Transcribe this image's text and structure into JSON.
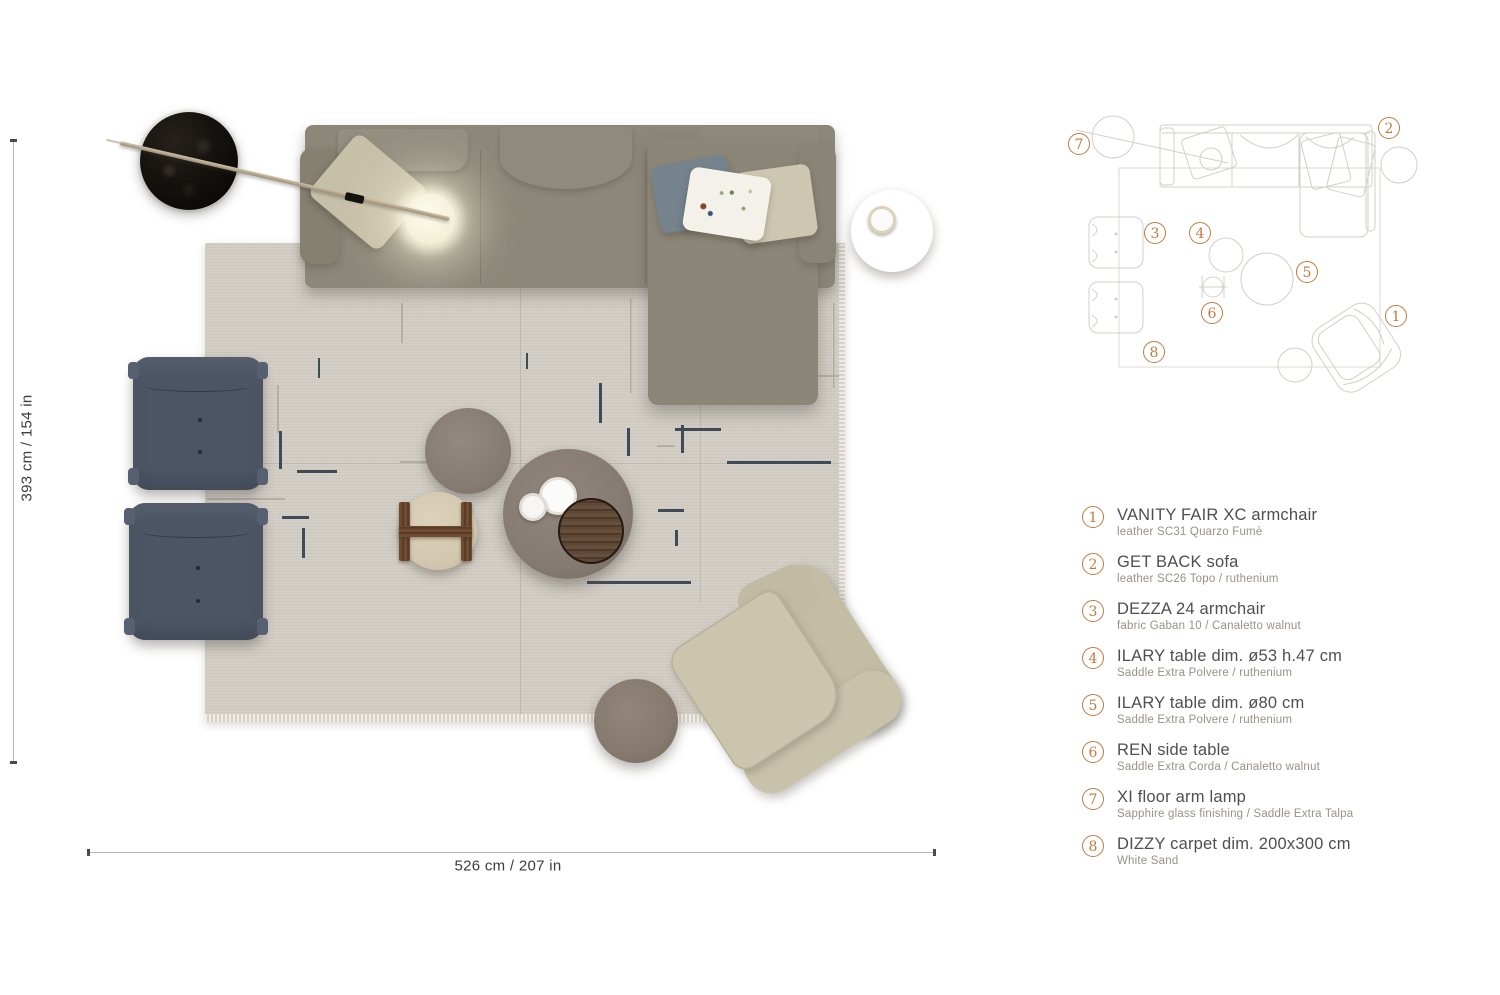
{
  "dimensions": {
    "vertical_label": "393 cm / 154 in",
    "horizontal_label": "526 cm / 207 in"
  },
  "legend": {
    "items": [
      {
        "num": "1",
        "title": "VANITY FAIR XC armchair",
        "spec": "leather SC31 Quarzo Fumè"
      },
      {
        "num": "2",
        "title": "GET BACK sofa",
        "spec": "leather SC26 Topo / ruthenium"
      },
      {
        "num": "3",
        "title": "DEZZA 24 armchair",
        "spec": "fabric Gaban 10 / Canaletto walnut"
      },
      {
        "num": "4",
        "title": "ILARY table dim. ø53 h.47 cm",
        "spec": "Saddle Extra Polvere / ruthenium"
      },
      {
        "num": "5",
        "title": "ILARY table dim. ø80 cm",
        "spec": "Saddle Extra Polvere / ruthenium"
      },
      {
        "num": "6",
        "title": "REN side table",
        "spec": "Saddle Extra Corda / Canaletto walnut"
      },
      {
        "num": "7",
        "title": "XI floor arm lamp",
        "spec": "Sapphire glass finishing / Saddle Extra Talpa"
      },
      {
        "num": "8",
        "title": "DIZZY carpet dim. 200x300 cm",
        "spec": "White Sand"
      }
    ]
  },
  "colors": {
    "accent_orange": "#c07a3e",
    "carpet_white_sand": "#d2cdc5",
    "sofa_leather_topo": "#8d8779",
    "armchair_fabric_gaban": "#4c5565",
    "armchair_leather_quarzo": "#c9c2ab",
    "canaletto_walnut": "#5f4936",
    "saddle_polvere": "#8b8077",
    "lamp_black": "#15120e"
  }
}
